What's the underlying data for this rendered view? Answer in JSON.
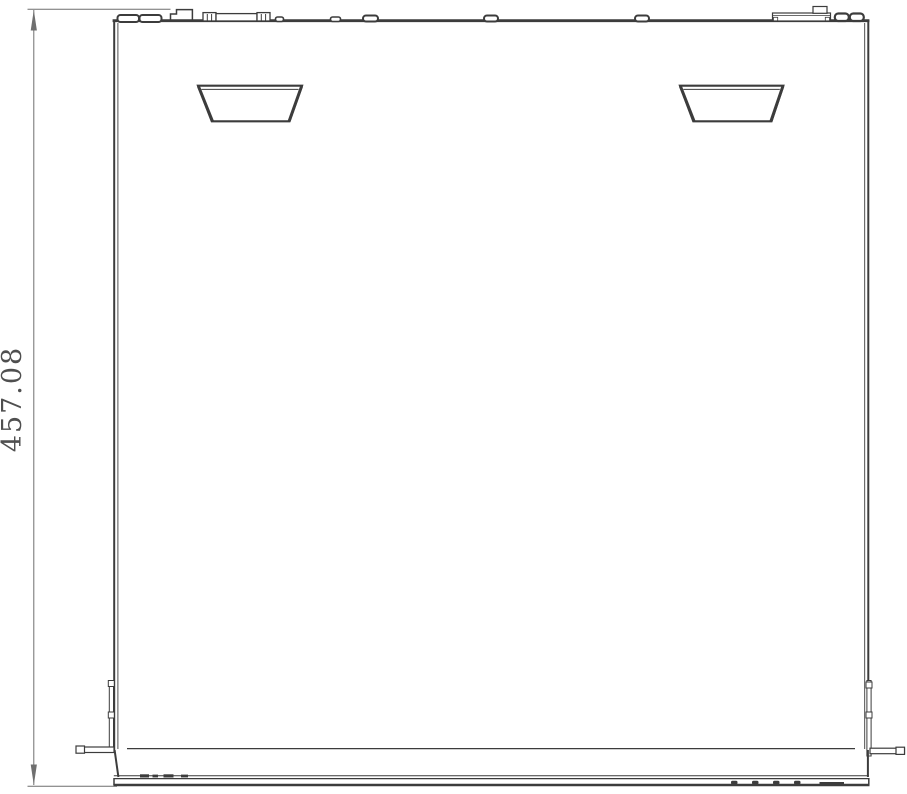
{
  "drawing": {
    "kind": "technical-top-view",
    "dimension": {
      "value": "457.08",
      "orientation": "vertical",
      "side": "left"
    },
    "features": {
      "handle_recesses": 2,
      "rear_connector_bumps": "RCA pair, riser connector, D-sub connector, small posts, terminal block with fuse cap, twin bumps",
      "rack_ears": [
        "left",
        "right"
      ],
      "front_panel": "full-width band with button bumps and slot marks"
    },
    "colors": {
      "line": "#3c3c3c",
      "dim": "#6f6f6f",
      "text": "#4f4f4f",
      "bg": "#ffffff"
    }
  }
}
